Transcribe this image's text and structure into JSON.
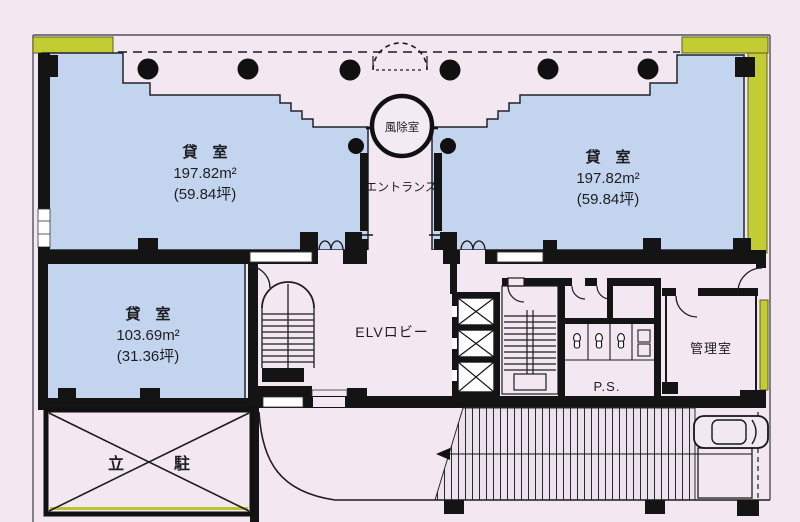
{
  "document": {
    "type": "floor-plan",
    "language": "ja"
  },
  "colors": {
    "background": "#f3e8f1",
    "room_fill": "#c3d5ee",
    "balcony_fill": "#c3cc32",
    "balcony_line": "#b9c230",
    "wall": "#141414",
    "hatch_bg": "#ece2ee"
  },
  "labels": {
    "room_nw": {
      "name": "貸　室",
      "area": "197.82m²",
      "tsubo": "(59.84坪)"
    },
    "room_ne": {
      "name": "貸　室",
      "area": "197.82m²",
      "tsubo": "(59.84坪)"
    },
    "room_sw": {
      "name": "貸　室",
      "area": "103.69m²",
      "tsubo": "(31.36坪)"
    },
    "windbreak_room": "風除室",
    "entrance": "エントランス",
    "elevator_lobby": "ELVロビー",
    "pipe_space": "P.S.",
    "manager_room": "管理室",
    "parking_left": "立",
    "parking_right": "駐"
  }
}
